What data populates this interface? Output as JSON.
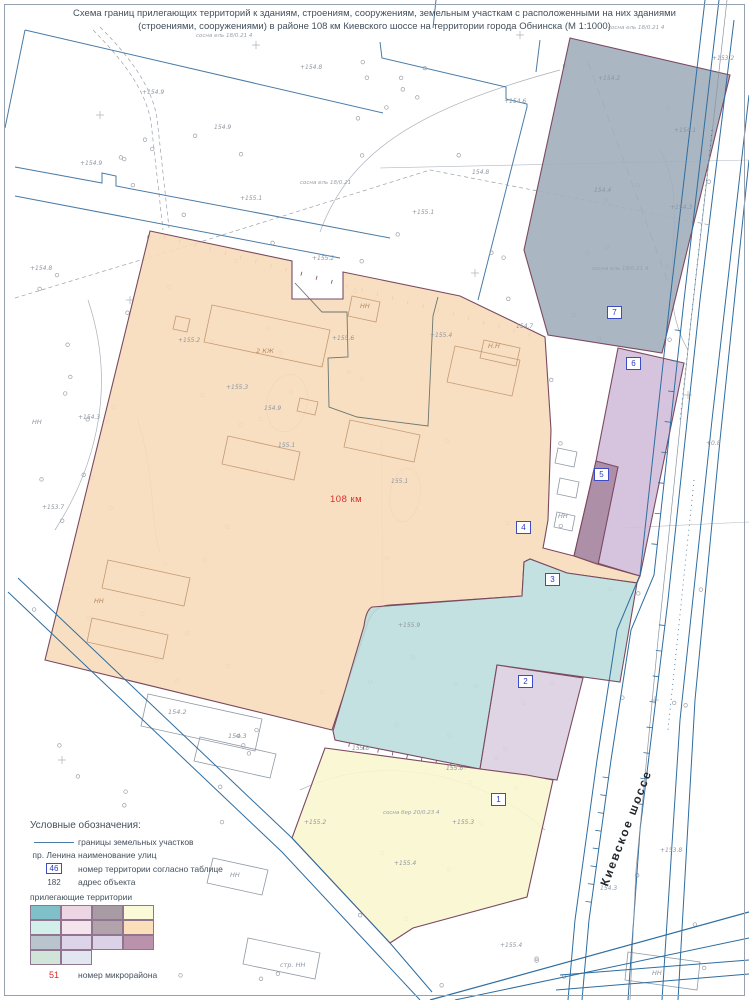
{
  "title": {
    "line1": "Схема границ прилегающих территорий к зданиям, строениям, сооружениям, земельным участкам с расположенными на них зданиями",
    "line2": "(строениями, сооружениями) в районе 108 км Киевского шоссе на территории города Обнинска (М 1:1000)"
  },
  "map": {
    "km_label": "108 км",
    "road_label": "Киевское шоссе",
    "territories": [
      {
        "number": "1",
        "fill": "#faf6cf",
        "badge_x": 491,
        "badge_y": 793
      },
      {
        "number": "2",
        "fill": "#dccfe0",
        "badge_x": 518,
        "badge_y": 675
      },
      {
        "number": "3",
        "fill": "#bcdedd",
        "badge_x": 545,
        "badge_y": 573
      },
      {
        "number": "4",
        "fill": "#f8dcba",
        "badge_x": 516,
        "badge_y": 521
      },
      {
        "number": "5",
        "fill": "#a98aa2",
        "badge_x": 594,
        "badge_y": 468
      },
      {
        "number": "6",
        "fill": "#d2bcda",
        "badge_x": 626,
        "badge_y": 357
      },
      {
        "number": "7",
        "fill": "#a2aebc",
        "badge_x": 607,
        "badge_y": 306
      }
    ],
    "elevations": [
      {
        "x": 300,
        "y": 64,
        "t": "+154.8"
      },
      {
        "x": 142,
        "y": 89,
        "t": "+154.9"
      },
      {
        "x": 214,
        "y": 124,
        "t": "154.9"
      },
      {
        "x": 240,
        "y": 195,
        "t": "+155.1"
      },
      {
        "x": 80,
        "y": 160,
        "t": "+154.9"
      },
      {
        "x": 30,
        "y": 265,
        "t": "+154.8"
      },
      {
        "x": 78,
        "y": 414,
        "t": "+154.3"
      },
      {
        "x": 42,
        "y": 504,
        "t": "+153.7"
      },
      {
        "x": 712,
        "y": 55,
        "t": "+153.2"
      },
      {
        "x": 598,
        "y": 75,
        "t": "+154.2"
      },
      {
        "x": 674,
        "y": 127,
        "t": "+154.1"
      },
      {
        "x": 594,
        "y": 187,
        "t": "154.4"
      },
      {
        "x": 670,
        "y": 204,
        "t": "+154.3"
      },
      {
        "x": 412,
        "y": 209,
        "t": "+155.1"
      },
      {
        "x": 472,
        "y": 169,
        "t": "154.8"
      },
      {
        "x": 504,
        "y": 98,
        "t": "+154.6"
      },
      {
        "x": 516,
        "y": 323,
        "t": "154.7"
      },
      {
        "x": 312,
        "y": 255,
        "t": "+155.2"
      },
      {
        "x": 178,
        "y": 337,
        "t": "+155.2"
      },
      {
        "x": 226,
        "y": 384,
        "t": "+155.3"
      },
      {
        "x": 332,
        "y": 335,
        "t": "+155.6"
      },
      {
        "x": 430,
        "y": 332,
        "t": "+155.4"
      },
      {
        "x": 264,
        "y": 405,
        "t": "154.9"
      },
      {
        "x": 278,
        "y": 442,
        "t": "155.1"
      },
      {
        "x": 391,
        "y": 478,
        "t": "155.1"
      },
      {
        "x": 398,
        "y": 622,
        "t": "+155.9"
      },
      {
        "x": 352,
        "y": 745,
        "t": "155.8"
      },
      {
        "x": 446,
        "y": 765,
        "t": "155.6"
      },
      {
        "x": 304,
        "y": 819,
        "t": "+155.2"
      },
      {
        "x": 452,
        "y": 819,
        "t": "+155.3"
      },
      {
        "x": 394,
        "y": 860,
        "t": "+155.4"
      },
      {
        "x": 706,
        "y": 440,
        "t": "+0.8"
      },
      {
        "x": 500,
        "y": 942,
        "t": "+155.4"
      },
      {
        "x": 660,
        "y": 847,
        "t": "+153.8"
      },
      {
        "x": 600,
        "y": 885,
        "t": "154.3"
      }
    ],
    "tree_notes": [
      {
        "x": 196,
        "y": 33,
        "t": "сосна ель 18/0.21 4"
      },
      {
        "x": 300,
        "y": 180,
        "t": "сосна ель 18/0.21"
      },
      {
        "x": 608,
        "y": 25,
        "t": "сосна ель 18/0.21 4"
      },
      {
        "x": 592,
        "y": 266,
        "t": "сосна ель 18/0.21 4"
      },
      {
        "x": 383,
        "y": 810,
        "t": "сосна бер 20/0.23 4"
      }
    ],
    "object_labels": [
      {
        "x": 256,
        "y": 347,
        "t": "2 КЖ",
        "c": "tan"
      },
      {
        "x": 360,
        "y": 302,
        "t": "НН",
        "c": "tan"
      },
      {
        "x": 488,
        "y": 342,
        "t": "Н.Н",
        "c": "tan"
      },
      {
        "x": 32,
        "y": 418,
        "t": "НН",
        "c": "gray"
      },
      {
        "x": 94,
        "y": 597,
        "t": "НН",
        "c": "tan"
      },
      {
        "x": 168,
        "y": 708,
        "t": "154.2",
        "c": "gray"
      },
      {
        "x": 228,
        "y": 732,
        "t": "154.3",
        "c": "gray"
      },
      {
        "x": 230,
        "y": 871,
        "t": "НН",
        "c": "gray"
      },
      {
        "x": 280,
        "y": 961,
        "t": "стр. НН",
        "c": "gray"
      },
      {
        "x": 652,
        "y": 969,
        "t": "НН",
        "c": "gray"
      },
      {
        "x": 558,
        "y": 512,
        "t": "НН",
        "c": "gray"
      }
    ],
    "colors": {
      "parcel_line": "#4a7ba6",
      "territory_border": "#7a4a60",
      "road_line": "#2e6da0",
      "contour": "#a9b0b8",
      "badge": "#3d4cc4",
      "km_red": "#e02a2a",
      "text": "#44505c"
    }
  },
  "legend": {
    "title": "Условные обозначения:",
    "items": [
      {
        "symbol": "line",
        "label": "границы земельных участков"
      },
      {
        "symbol": "пр. Ленина",
        "label": "наименование улиц"
      },
      {
        "symbol": "46",
        "label": "номер территории согласно таблице"
      },
      {
        "symbol": "182",
        "label": "адрес объекта"
      }
    ],
    "adjacent_title": "прилегающие территории",
    "swatches": [
      "#7fc0c9",
      "#eed5e4",
      "#a89ba3",
      "#fafad8",
      "#d3efe9",
      "#f5e4ec",
      "#b1a3a9",
      "#fbdfb9",
      "#bac4cd",
      "#ded4e9",
      "#dcd2e7",
      "#bb92ac",
      "#d0e4d7",
      "#e2e6f0"
    ],
    "micro": {
      "symbol": "51",
      "label": "номер микрорайона"
    }
  }
}
